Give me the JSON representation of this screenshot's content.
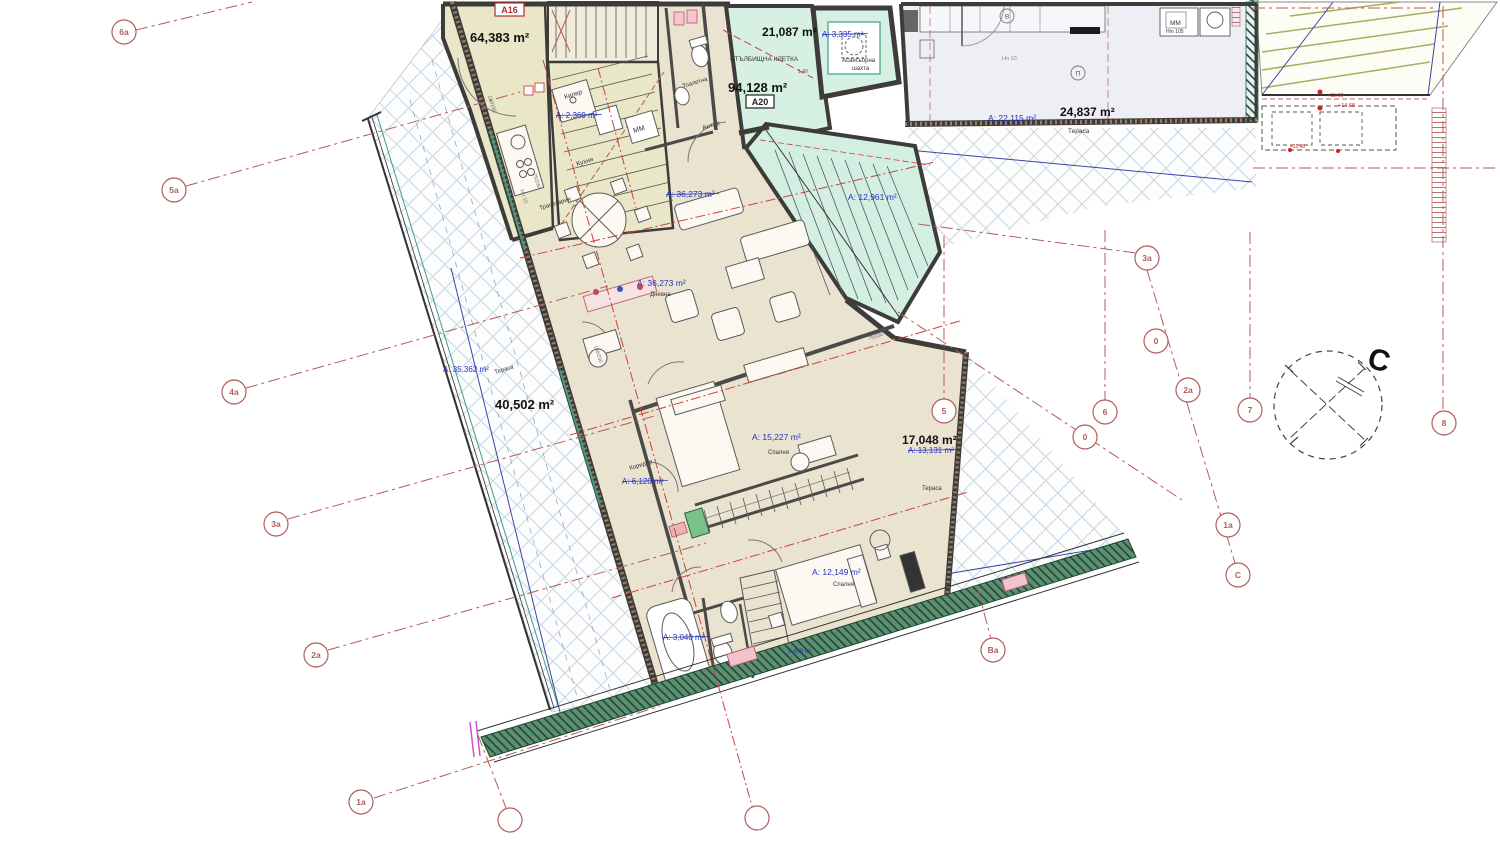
{
  "plan_name": "apartment-floor-plan",
  "colors": {
    "floor_beige": "#eae3d0",
    "floor_khaki": "#e9e7c8",
    "floor_mint": "#d7f0e4",
    "strip_floor": "#edeff4",
    "wall_dark": "#3d3c3a",
    "wall_brown": "#9b7f63",
    "grid_red": "#b25c5c",
    "center_red": "#cc4040",
    "label_blue": "#2433c0",
    "line_blue": "#3a46a8",
    "hatch_blue": "#c3d6e4",
    "band_green": "#5d8f72",
    "roof_olive": "#a8ac62"
  },
  "labels": {
    "bold": [
      {
        "t": "64,383 m²",
        "x": 470,
        "y": 42,
        "s": 13
      },
      {
        "t": "21,087 m²",
        "x": 762,
        "y": 36,
        "s": 12
      },
      {
        "t": "94,128 m²",
        "x": 728,
        "y": 92,
        "s": 13
      },
      {
        "t": "24,837 m²",
        "x": 1060,
        "y": 116,
        "s": 12
      },
      {
        "t": "40,502 m²",
        "x": 495,
        "y": 409,
        "s": 13
      },
      {
        "t": "17,048 m²",
        "x": 902,
        "y": 444,
        "s": 12
      }
    ],
    "blue": [
      {
        "t": "А: 2,369 m²",
        "x": 556,
        "y": 118,
        "s": 8,
        "strike": true
      },
      {
        "t": "А: 36,273 m²",
        "x": 666,
        "y": 197,
        "s": 8.5,
        "strike": true
      },
      {
        "t": "А: 36,273 m²",
        "x": 637,
        "y": 286,
        "s": 8.5
      },
      {
        "t": "А: 12,961 m²",
        "x": 848,
        "y": 200,
        "s": 8.5
      },
      {
        "t": "А: 35,362 m²",
        "x": 443,
        "y": 372,
        "s": 8
      },
      {
        "t": "А: 15,227 m²",
        "x": 752,
        "y": 440,
        "s": 8.5
      },
      {
        "t": "А: 6,120 m²",
        "x": 622,
        "y": 484,
        "s": 8,
        "strike": true
      },
      {
        "t": "А: 13,131 m²",
        "x": 908,
        "y": 453,
        "s": 8,
        "strike": true
      },
      {
        "t": "А: 12,149 m²",
        "x": 812,
        "y": 575,
        "s": 8.5
      },
      {
        "t": "А: 3,040 m²",
        "x": 663,
        "y": 640,
        "s": 8,
        "strike": true
      },
      {
        "t": "А: 3,335 m²",
        "x": 822,
        "y": 37,
        "s": 8,
        "strike": true
      },
      {
        "t": "А: 22,115 m²",
        "x": 988,
        "y": 121,
        "s": 8.5
      },
      {
        "t": "3,489 m²",
        "x": 788,
        "y": 653,
        "s": 6
      }
    ],
    "rooms": [
      {
        "t": "СТЪЛБИЩНА КЛЕТКА",
        "x": 730,
        "y": 61,
        "s": 6.5
      },
      {
        "t": "Асансьорна",
        "x": 842,
        "y": 62,
        "s": 6
      },
      {
        "t": "шахта",
        "x": 852,
        "y": 70,
        "s": 6
      },
      {
        "t": "Тоалетна",
        "x": 683,
        "y": 88,
        "s": 6,
        "rot": -17
      },
      {
        "t": "Антре",
        "x": 703,
        "y": 130,
        "s": 6.5,
        "rot": -17
      },
      {
        "t": "Килер",
        "x": 565,
        "y": 99,
        "s": 6.5,
        "rot": -17
      },
      {
        "t": "Кухня",
        "x": 577,
        "y": 166,
        "s": 6.5,
        "rot": -17
      },
      {
        "t": "Трапезария",
        "x": 540,
        "y": 210,
        "s": 6,
        "rot": -17
      },
      {
        "t": "МM",
        "x": 634,
        "y": 133,
        "s": 7,
        "rot": -17
      },
      {
        "t": "Дневна",
        "x": 650,
        "y": 296,
        "s": 6,
        "rot": 0
      },
      {
        "t": "Тераса",
        "x": 495,
        "y": 374,
        "s": 6,
        "rot": -17
      },
      {
        "t": "Спалня",
        "x": 768,
        "y": 454,
        "s": 6
      },
      {
        "t": "Коридор",
        "x": 630,
        "y": 470,
        "s": 6,
        "rot": -17
      },
      {
        "t": "Тераса",
        "x": 922,
        "y": 490,
        "s": 6
      },
      {
        "t": "Спалня",
        "x": 833,
        "y": 586,
        "s": 6
      },
      {
        "t": "Тераса",
        "x": 1068,
        "y": 133,
        "s": 6.5
      },
      {
        "t": "МM",
        "x": 1170,
        "y": 25,
        "s": 6.5
      },
      {
        "t": "Hm 105",
        "x": 1166,
        "y": 33,
        "s": 5
      }
    ],
    "tiny": [
      {
        "t": "Hn 10",
        "x": 1002,
        "y": 60,
        "s": 5.5,
        "c": "#888"
      },
      {
        "t": "Hn 10",
        "x": 520,
        "y": 190,
        "s": 5.5,
        "c": "#888",
        "rot": 72
      },
      {
        "t": "110/230",
        "x": 488,
        "y": 96,
        "s": 5,
        "c": "#666",
        "rot": 72
      },
      {
        "t": "75/230",
        "x": 533,
        "y": 174,
        "s": 5,
        "c": "#666",
        "rot": 72
      },
      {
        "t": "150/230",
        "x": 594,
        "y": 346,
        "s": 5,
        "c": "#666",
        "rot": 72
      },
      {
        "t": "75/230",
        "x": 869,
        "y": 340,
        "s": 5,
        "c": "#666",
        "rot": -17
      }
    ],
    "red": [
      {
        "t": "+11.60",
        "x": 1327,
        "y": 97,
        "s": 5.5
      },
      {
        "t": "+14.68",
        "x": 1338,
        "y": 107,
        "s": 5.5
      },
      {
        "t": "+11.48",
        "x": 1290,
        "y": 148,
        "s": 5
      },
      {
        "t": "1.40",
        "x": 798,
        "y": 73,
        "s": 5
      }
    ]
  },
  "boxes": [
    {
      "t": "A16",
      "x": 495,
      "y": 3,
      "w": 29,
      "h": 13,
      "c": "#b03030"
    },
    {
      "t": "A20",
      "x": 746,
      "y": 95,
      "w": 28,
      "h": 13,
      "c": "#222222"
    }
  ],
  "grid_markers": [
    {
      "t": "6a",
      "x": 124,
      "y": 32
    },
    {
      "t": "5a",
      "x": 174,
      "y": 190
    },
    {
      "t": "4a",
      "x": 234,
      "y": 392
    },
    {
      "t": "3a",
      "x": 276,
      "y": 524
    },
    {
      "t": "2a",
      "x": 316,
      "y": 655
    },
    {
      "t": "1a",
      "x": 361,
      "y": 802
    },
    {
      "t": "3a",
      "x": 1147,
      "y": 258
    },
    {
      "t": "0",
      "x": 1156,
      "y": 341
    },
    {
      "t": "2a",
      "x": 1188,
      "y": 390
    },
    {
      "t": "5",
      "x": 944,
      "y": 411
    },
    {
      "t": "6",
      "x": 1105,
      "y": 412
    },
    {
      "t": "0",
      "x": 1085,
      "y": 437
    },
    {
      "t": "7",
      "x": 1250,
      "y": 410
    },
    {
      "t": "8",
      "x": 1444,
      "y": 423
    },
    {
      "t": "1a",
      "x": 1228,
      "y": 525
    },
    {
      "t": "C",
      "x": 1238,
      "y": 575
    },
    {
      "t": "Ba",
      "x": 993,
      "y": 650
    }
  ],
  "small_markers": [
    {
      "t": "В",
      "x": 1007,
      "y": 16
    },
    {
      "t": "П",
      "x": 1078,
      "y": 73
    }
  ],
  "empty_markers": [
    {
      "x": 757,
      "y": 818
    },
    {
      "x": 510,
      "y": 820
    }
  ],
  "compass": {
    "letter": "С",
    "cx": 1328,
    "cy": 405,
    "r": 54
  }
}
